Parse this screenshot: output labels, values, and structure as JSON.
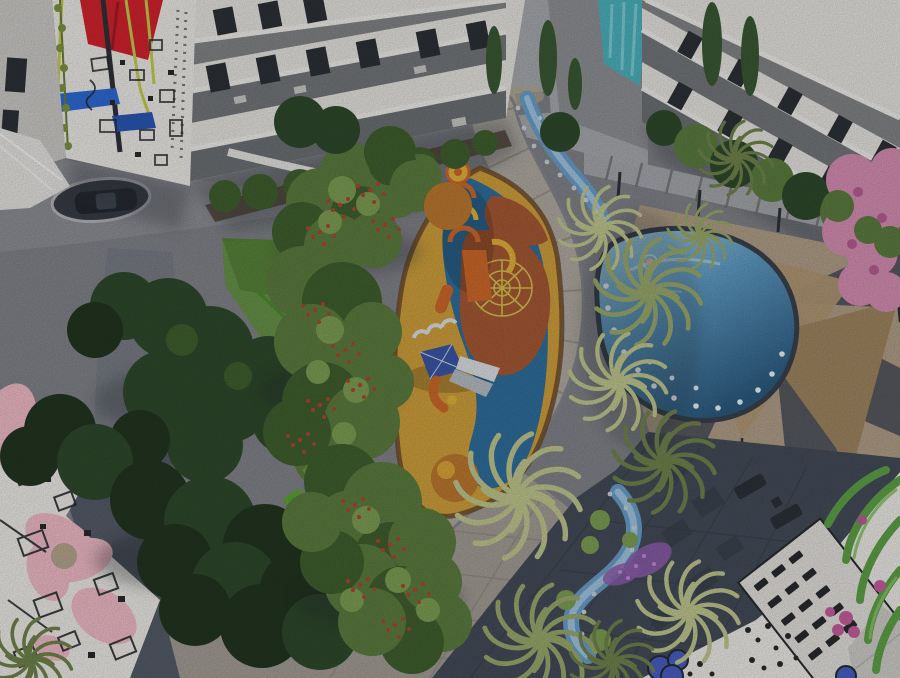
{
  "scene": {
    "description": "Aerial 3D architectural rendering of an apartment complex courtyard with a children's playground, rope climbing net, illuminated swimming pool, tan shade sails, palm trees, a winding stream, curved gray pathways, a parked car, and building corners painted with black-and-white doodle murals accented in red, blue, teal and pink"
  },
  "palette": {
    "base": "#83858b",
    "plazaCool": "#8f9096",
    "plazaWarm": "#a59f97",
    "pathMid": "#7a7e87",
    "pathDark": "#565d6a",
    "walkway": "#b2ada4",
    "walkwayEdge": "#87898f",
    "wallBack": "#a9abaf",
    "wallShadow": "#60646b",
    "white": "#e9e7e2",
    "facadeShade": "#cdccc9",
    "recess": "#585d63",
    "windowDark": "#2d3237",
    "slab": "#f2f1ee",
    "muralWhite": "#f0eeea",
    "ink": "#282b2f",
    "red": "#d5242e",
    "blue": "#2f6cd8",
    "blueDeep": "#2a58b8",
    "rope": "#c6cf4e",
    "teal": "#4db4c0",
    "tealLight": "#8ad7dd",
    "pinkSoft": "#f2bdc9",
    "leafGreen": "#5fa348",
    "leafLight": "#8cc56a",
    "magenta": "#c9609e",
    "cobalt": "#4a5fc8",
    "playYellow": "#d2a23d",
    "playBlue": "#30709f",
    "terracotta": "#a85a35",
    "curb": "#6f4e2d",
    "orange": "#d06a2a",
    "yellow": "#e5b43c",
    "canopy": "#3b57a9",
    "slideLight": "#dfe3e6",
    "slideGray": "#b8bfc5",
    "net": "#d9c44e",
    "poolLight": "#a9d5e9",
    "poolMid": "#5f9dc5",
    "poolDeep": "#2d5b81",
    "poolCurb": "#39424e",
    "dot": "#edf8fd",
    "stream": "#6ba1cd",
    "streamCore": "#adcfe8",
    "stone": "#ced4d9",
    "grass": "#689549",
    "grassShade": "#4a7330",
    "hedge": "#4e8d30",
    "hedgeLight": "#6aad42",
    "bush": "#5d7e40",
    "bushLight": "#7fa055",
    "bushDark": "#41602f",
    "treeDark": "#2f4a2c",
    "treeDarker": "#233620",
    "berry": "#b64530",
    "orangeBush": "#bf7a30",
    "palm": "#9cab6d",
    "palmLight": "#c2c98f",
    "palmDark": "#71854d",
    "cypress": "#3a5a34",
    "sail": "#b49a77",
    "sailDark": "#a18762",
    "sand": "#b3a089",
    "wedge": "#484e59",
    "terrace": "#454d5a",
    "terraceLine": "#363d49",
    "lounger": "#2c3239",
    "car": "#23272e",
    "carGlass": "#4a525c",
    "opening": "#3a3e46",
    "purple": "#8f5fae",
    "purpleLight": "#c093d6",
    "pinkTree": "#d890b5",
    "pinkDeep": "#b95f95",
    "trunk": "#6b5843",
    "skin": "#e9b893",
    "vine": "#7f9444",
    "planter": "#4a4034",
    "pole": "#2e3238",
    "ring": "#b7b8bd",
    "rail": "#e8e7e4",
    "gravel": "#b8a98f",
    "shadow": "#2f343c"
  }
}
